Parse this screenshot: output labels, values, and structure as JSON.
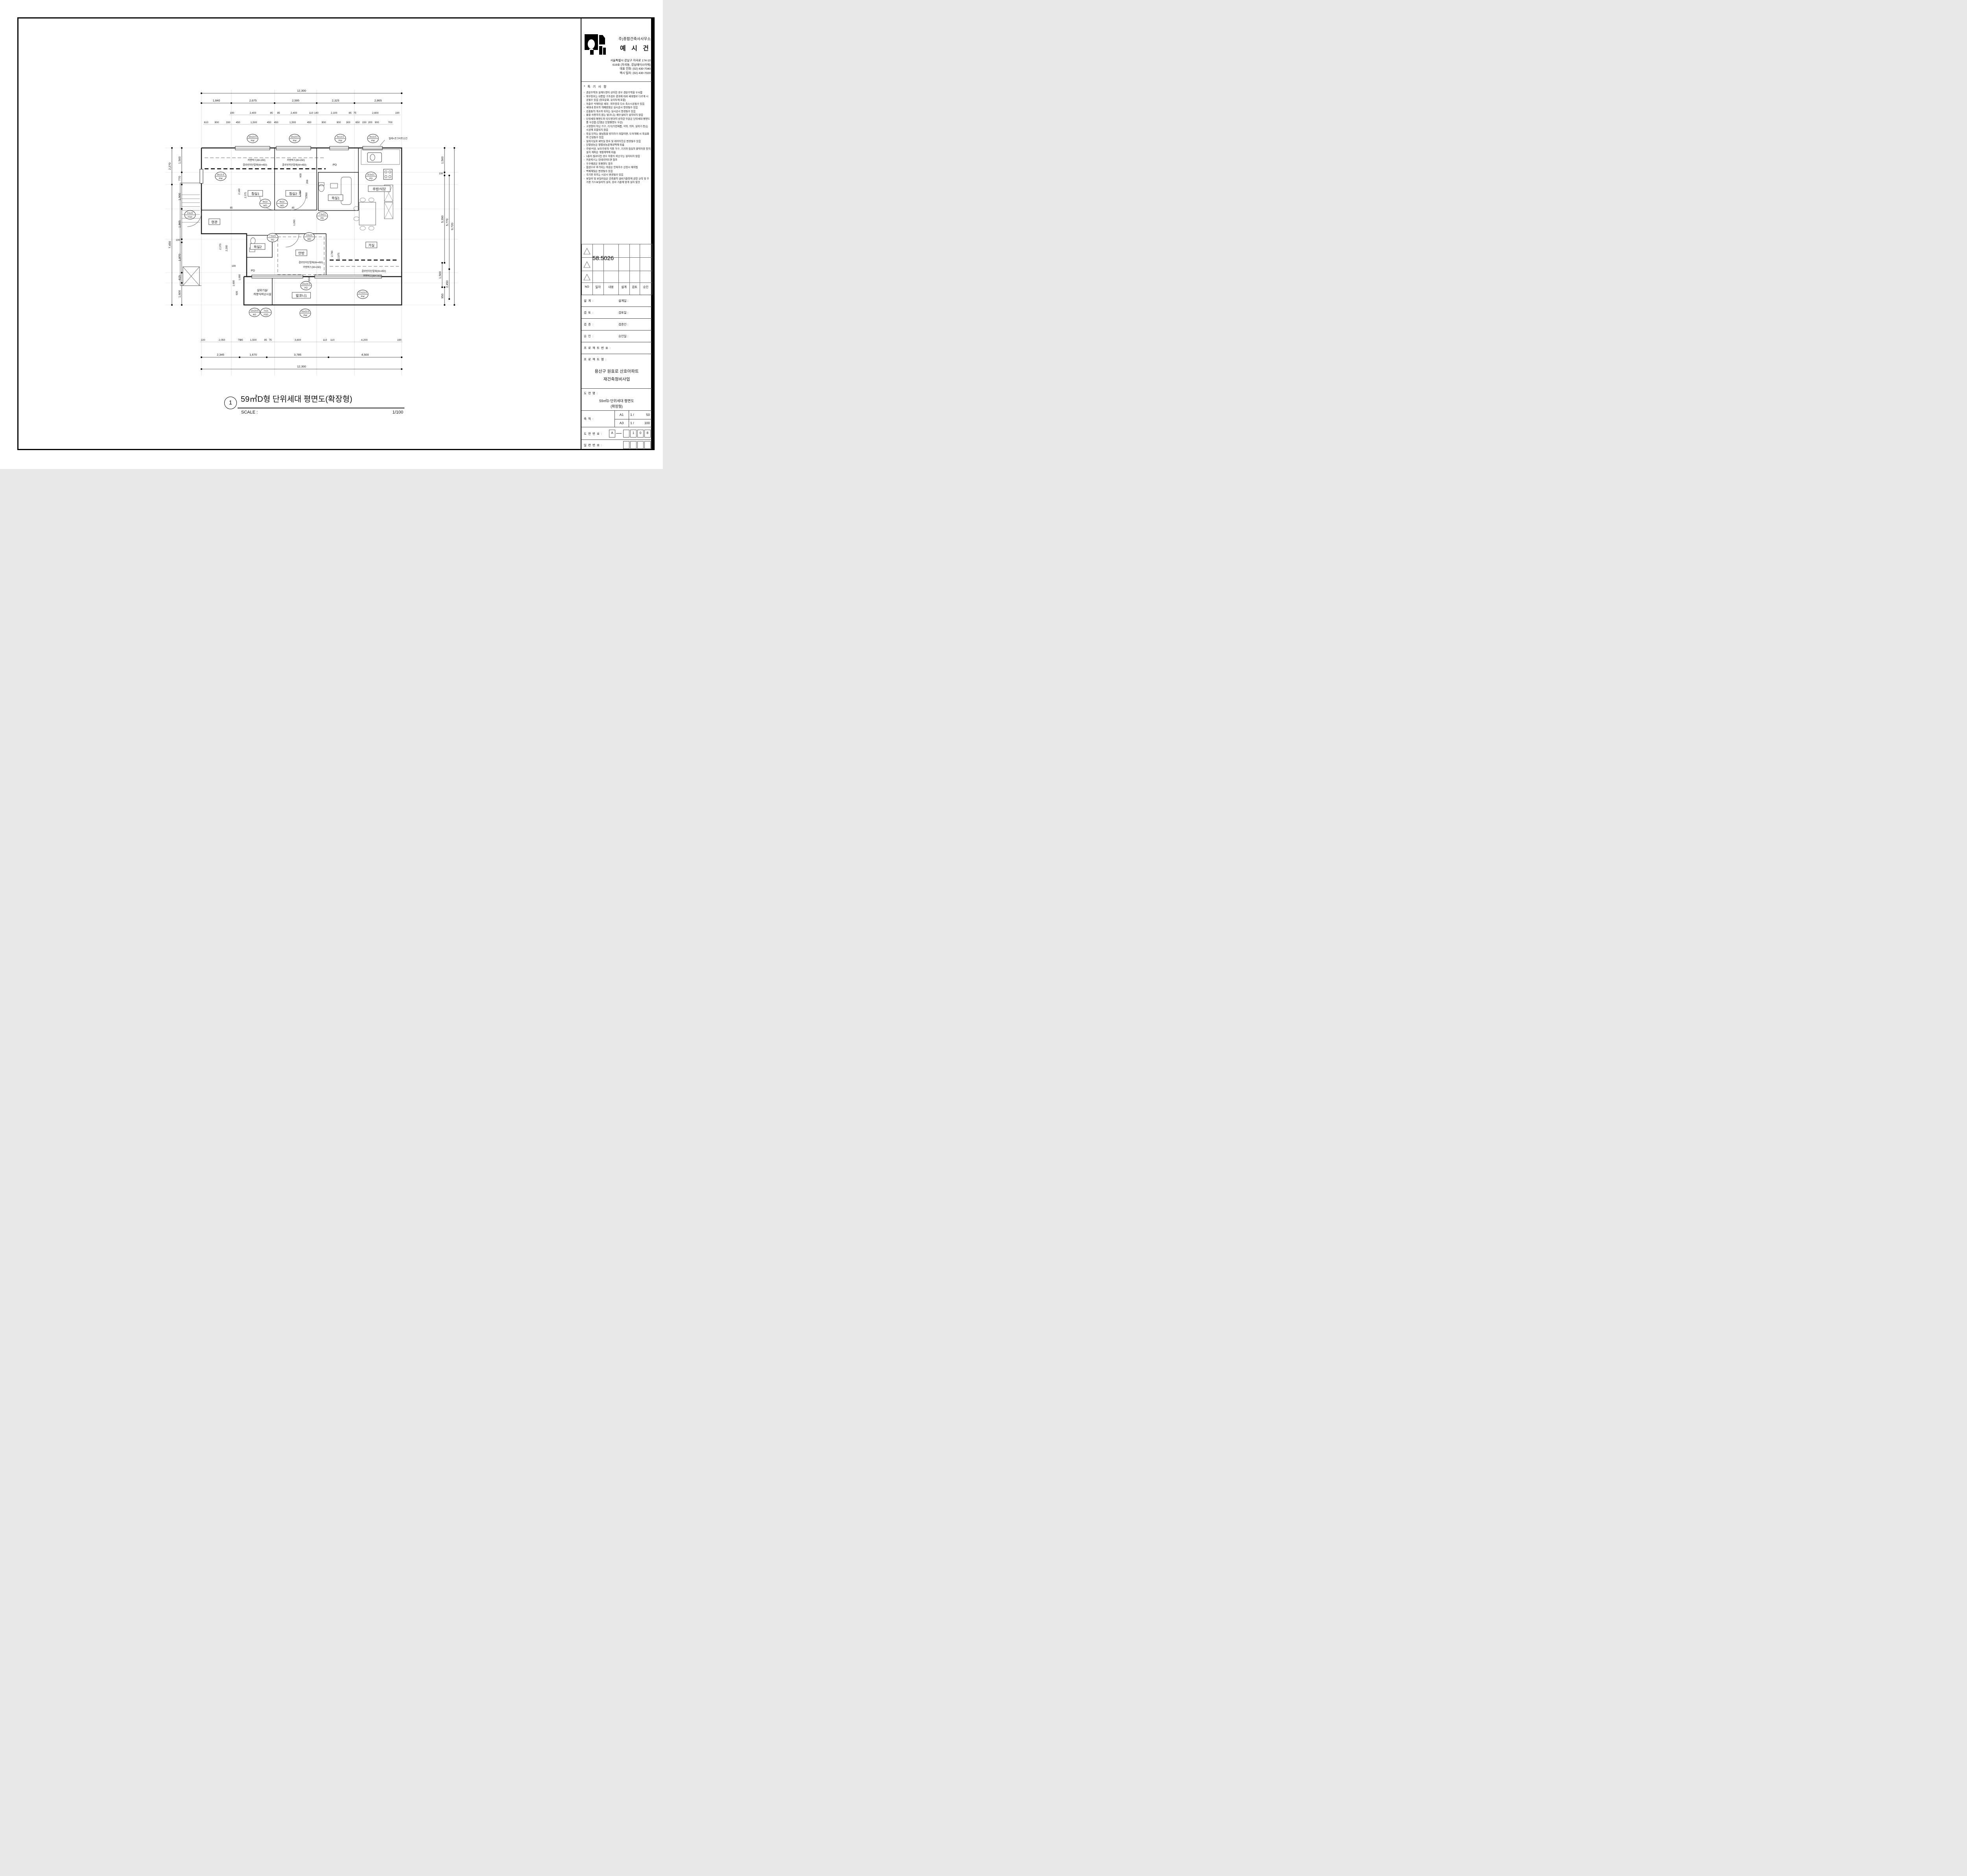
{
  "title_block": {
    "company_small": "주)종합건축사사무소",
    "company_large": "예 시 건",
    "address_lines": [
      "서울특별시 강남구 자곡로 174-10",
      "619호 (자곡동, 강남에이스타워)",
      "대표 전화: (02) 430-7040",
      "팩시 밀리: (02) 430-7020"
    ],
    "notes_title": "* 특 기 사 항",
    "notes": [
      "견본주택과 설계도면이 상이한 경우 견본주택을 우서함",
      "외부창호는 내풍압 구조검토 결과에 따라 세대별로 다르게 시공될수 있음 (창호분화, 유리두께 포함)",
      "저층부 석재마감 세대 :  외부창호 다소 축소시공될수 있음",
      "세대내 창호의 개폐방향은 실시공시 변경될수 있음",
      "선홈통의 개소와 위치는 실시공시 변경될수 있음",
      "물을 사용하지 않는 발코니는 배수설비가 설치되지 않음",
      "단위세대 평면도와 타도면과의 상히한 부분은 단위세대 평면도를 우선함 (단열은 단열평면도 우선)",
      "고정형이 아닌 가구, 기기(가전제품, 식탁, 의자, 실외기 등)는 시공에 포함되지 않음",
      "욕실 단차는 물넘침을 방지하기 위함이면, 도어개폐 시 욕실화와 간설될수 있음",
      "실외기실과 세탁실 창호 및 레이아웃은 변경될수 있음",
      "단열성능은 형별성능관계내역에 따름",
      "주방/식당, 보조주방의 각종 가구, 기기와 침실의 붙박이장 등의 설치 계획은 개별계약에 따름",
      "1층이 필로티인 경우 하향식 피난구는 설치되지 않음",
      "커튼박스는 인테리어도면 참조",
      "우수배관은 동평면도 참조",
      "옵션으로 추가되는 마감은 안목치수 산정시 제외됨",
      "벽체재질은 변경될수 있음",
      "국기봉 위치는 시공시 변경될수 있음",
      "보일러 및 보일러실은 건축물의 설비기준등에 관한 규칙 및 주거용 가스보일러의 설치, 검사 기준에 맞게 설치 할것"
    ],
    "revision_number": "58.5026",
    "revision_headers": [
      "NO",
      "일자",
      "내용",
      "설계",
      "검토",
      "승인"
    ],
    "sign_rows": [
      {
        "left": "설 계 :",
        "right": "설계일 :"
      },
      {
        "left": "검 토 :",
        "right": "검토일 :"
      },
      {
        "left": "검 증 :",
        "right": "검증인 :"
      },
      {
        "left": "승 인 :",
        "right": "승인일 :"
      }
    ],
    "project_no_label": "프 로 젝 트 번 호 :",
    "project_label": "프 로 젝 트 명 :",
    "project_name_lines": [
      "용산구 원효로 산호아파트",
      "재건축정비사업"
    ],
    "drawing_label": "도 면 명 :",
    "drawing_name_lines": [
      "59㎡D 단위세대 평면도",
      "(확장형)"
    ],
    "scale_label": "축        척 :",
    "scale_rows": [
      {
        "sheet": "A1",
        "ratio": "1 /",
        "value": "50"
      },
      {
        "sheet": "A3",
        "ratio": "1 /",
        "value": "100"
      }
    ],
    "drawing_no_label": "도 면 번 호 :",
    "drawing_no_prefix": "A",
    "drawing_no_boxes": [
      "",
      "1",
      "0",
      "8"
    ],
    "serial_label": "일 련 번 호 :"
  },
  "footer": {
    "number": "1",
    "title": "59㎡D형 단위세대 평면도(확장형)",
    "scale_label": "SCALE :",
    "scale_value": "1/100"
  },
  "plan": {
    "rooms": [
      "침실1",
      "침실2",
      "욕실1",
      "주방/식당",
      "현관",
      "욕실2",
      "안방",
      "거실",
      "발코니1"
    ],
    "room_outdoor_lines": [
      "실외기실/",
      "하향식피난시설"
    ],
    "pd_labels": [
      "PD",
      "PD"
    ],
    "window_tags": [
      {
        "size": "15x23.5",
        "code": "PW"
      },
      {
        "size": "15x23.5",
        "code": "PW"
      },
      {
        "size": "9x13.5",
        "code": "PW"
      },
      {
        "size": "9x13.5",
        "code": "PW"
      },
      {
        "size": "8x13.5",
        "code": "PW"
      },
      {
        "size": "9x22",
        "code": "WD"
      },
      {
        "size": "9x22",
        "code": "WD"
      },
      {
        "size": "7.5x21",
        "code": "PD"
      },
      {
        "size": "10x22",
        "code": "FSD"
      },
      {
        "size": "7.5x21",
        "code": "PD"
      },
      {
        "size": "10x22",
        "code": "WD"
      },
      {
        "size": "8.5x21",
        "code": "PD"
      },
      {
        "size": "15x24.5",
        "code": "PD"
      },
      {
        "size": "27x23.5",
        "code": "PW"
      },
      {
        "size": "11x23.5",
        "code": "AG"
      },
      {
        "size": "7x21",
        "code": "FSD"
      },
      {
        "size": "15x23.5",
        "code": "PW"
      }
    ],
    "annotations": [
      "커텐박스(W=150)",
      "결로방지단열재(W=450)",
      "커텐박스(W=150)",
      "결로방지단열재(W=450)",
      "철제+콘크리트난간",
      "결로방지단열재(W=450)",
      "커텐박스(W=150)",
      "결로방지단열재(W=450)",
      "커텐박스(W=150)"
    ],
    "dims": {
      "top1": [
        "12,300"
      ],
      "top2": [
        "1,840",
        "2,675",
        "2,595",
        "2,325",
        "2,865"
      ],
      "top3": [
        "190",
        "2,400",
        "85",
        "85",
        "2,400",
        "110",
        "140",
        "2,100",
        "85",
        "75",
        "2,600",
        "190"
      ],
      "top4": [
        "610",
        "900",
        "330",
        "450",
        "1,500",
        "450",
        "450",
        "1,500",
        "450",
        "900",
        "900",
        "300",
        "650",
        "150",
        "200",
        "900",
        "700"
      ],
      "bottom1": [
        "220",
        "2,050",
        "75",
        "85",
        "1,500",
        "85",
        "75",
        "3,600",
        "110",
        "110",
        "4,200",
        "190"
      ],
      "bottom2": [
        "2,345",
        "1,670",
        "3,785",
        "4,500"
      ],
      "bottom3": [
        "12,300"
      ],
      "left_outer": [
        "2,270",
        "7,450"
      ],
      "left_inner": [
        "1,500",
        "770",
        "1,500",
        "1,865",
        "190",
        "1,870",
        "615",
        "1,600"
      ],
      "right": [
        "1,500",
        "190",
        "5,390",
        "5,770",
        "9,720",
        "1,500",
        "2,450",
        "950"
      ],
      "interior": [
        "2,100",
        "2,375",
        "1,785",
        "1,500",
        "600",
        "200",
        "2,370",
        "2,200",
        "2,700",
        "2,975",
        "1,600",
        "1,000",
        "600",
        "190",
        "85",
        "85",
        "1,260",
        "650"
      ]
    }
  }
}
